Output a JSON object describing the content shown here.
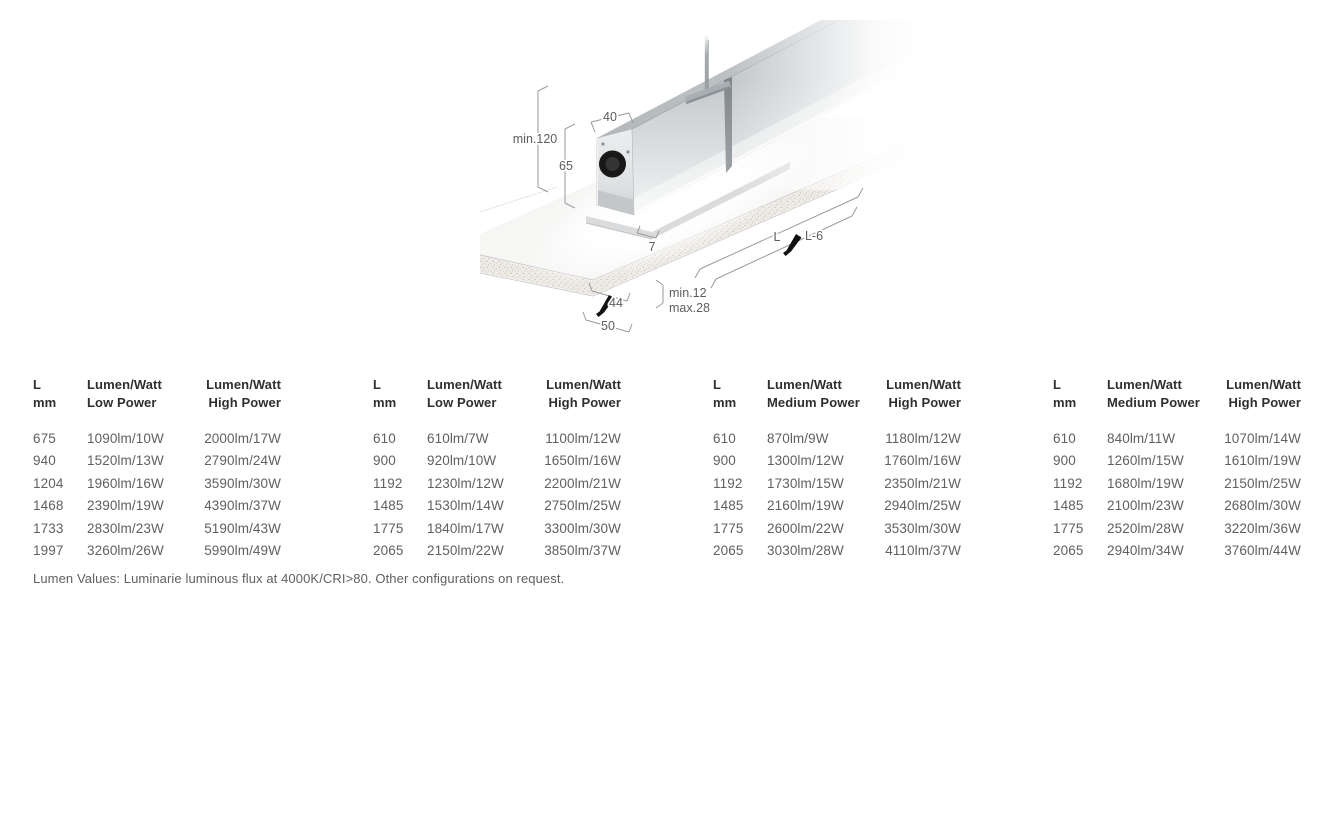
{
  "diagram": {
    "dims": {
      "top_width": "40",
      "recess_depth": "min.120",
      "body_height": "65",
      "trim_height": "7",
      "length": "L",
      "cutout_length": "L-6",
      "panel_thickness_min": "min.12",
      "panel_thickness_max": "max.28",
      "cutout_width": "44",
      "flange_width": "50"
    }
  },
  "tables": [
    {
      "headers": [
        [
          "L",
          "mm"
        ],
        [
          "Lumen/Watt",
          "Low Power"
        ],
        [
          "Lumen/Watt",
          "High Power"
        ]
      ],
      "rows": [
        [
          "675",
          "1090lm/10W",
          "2000lm/17W"
        ],
        [
          "940",
          "1520lm/13W",
          "2790lm/24W"
        ],
        [
          "1204",
          "1960lm/16W",
          "3590lm/30W"
        ],
        [
          "1468",
          "2390lm/19W",
          "4390lm/37W"
        ],
        [
          "1733",
          "2830lm/23W",
          "5190lm/43W"
        ],
        [
          "1997",
          "3260lm/26W",
          "5990lm/49W"
        ]
      ]
    },
    {
      "headers": [
        [
          "L",
          "mm"
        ],
        [
          "Lumen/Watt",
          "Low Power"
        ],
        [
          "Lumen/Watt",
          "High Power"
        ]
      ],
      "rows": [
        [
          "610",
          "610lm/7W",
          "1100lm/12W"
        ],
        [
          "900",
          "920lm/10W",
          "1650lm/16W"
        ],
        [
          "1192",
          "1230lm/12W",
          "2200lm/21W"
        ],
        [
          "1485",
          "1530lm/14W",
          "2750lm/25W"
        ],
        [
          "1775",
          "1840lm/17W",
          "3300lm/30W"
        ],
        [
          "2065",
          "2150lm/22W",
          "3850lm/37W"
        ]
      ]
    },
    {
      "headers": [
        [
          "L",
          "mm"
        ],
        [
          "Lumen/Watt",
          "Medium Power"
        ],
        [
          "Lumen/Watt",
          "High Power"
        ]
      ],
      "rows": [
        [
          "610",
          "870lm/9W",
          "1180lm/12W"
        ],
        [
          "900",
          "1300lm/12W",
          "1760lm/16W"
        ],
        [
          "1192",
          "1730lm/15W",
          "2350lm/21W"
        ],
        [
          "1485",
          "2160lm/19W",
          "2940lm/25W"
        ],
        [
          "1775",
          "2600lm/22W",
          "3530lm/30W"
        ],
        [
          "2065",
          "3030lm/28W",
          "4110lm/37W"
        ]
      ]
    },
    {
      "headers": [
        [
          "L",
          "mm"
        ],
        [
          "Lumen/Watt",
          "Medium Power"
        ],
        [
          "Lumen/Watt",
          "High Power"
        ]
      ],
      "rows": [
        [
          "610",
          "840lm/11W",
          "1070lm/14W"
        ],
        [
          "900",
          "1260lm/15W",
          "1610lm/19W"
        ],
        [
          "1192",
          "1680lm/19W",
          "2150lm/25W"
        ],
        [
          "1485",
          "2100lm/23W",
          "2680lm/30W"
        ],
        [
          "1775",
          "2520lm/28W",
          "3220lm/36W"
        ],
        [
          "2065",
          "2940lm/34W",
          "3760lm/44W"
        ]
      ]
    }
  ],
  "footnote": "Lumen Values: Luminarie luminous flux at 4000K/CRI>80. Other configurations on request.",
  "colors": {
    "header_text": "#2f2f2f",
    "value_text": "#606060",
    "dim_text": "#5e5e5e",
    "dim_line": "#9a9a9a",
    "marker": "#111111"
  }
}
